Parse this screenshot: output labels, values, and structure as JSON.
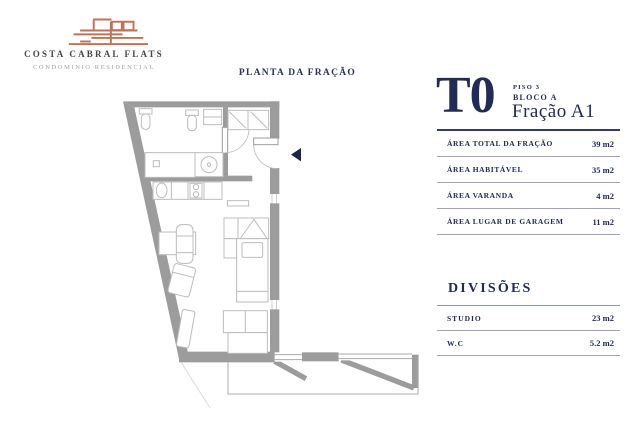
{
  "brand": {
    "name": "COSTA CABRAL FLATS",
    "tagline": "CONDOMINIO RESIDENCIAL"
  },
  "plan_title": "PLANTA DA FRAÇÃO",
  "unit": {
    "type": "T0",
    "floor": "PISO 3",
    "block": "BLOCO A",
    "fraction": "Fração A1"
  },
  "areas": {
    "rows": [
      {
        "label": "ÁREA TOTAL DA FRAÇÃO",
        "value": "39 m2"
      },
      {
        "label": "ÁREA HABITÁVEL",
        "value": "35 m2"
      },
      {
        "label": "ÁREA VARANDA",
        "value": "4 m2"
      },
      {
        "label": "ÁREA LUGAR DE GARAGEM",
        "value": "11 m2"
      }
    ]
  },
  "divisions": {
    "title": "DIVISÕES",
    "rows": [
      {
        "label": "STUDIO",
        "value": "23 m2"
      },
      {
        "label": "W.C",
        "value": "5.2 m2"
      }
    ]
  },
  "colors": {
    "navy": "#212b56",
    "terracotta": "#bf7258",
    "wall_gray": "#9c9c9c",
    "furniture_gray": "#bcbcbc"
  }
}
